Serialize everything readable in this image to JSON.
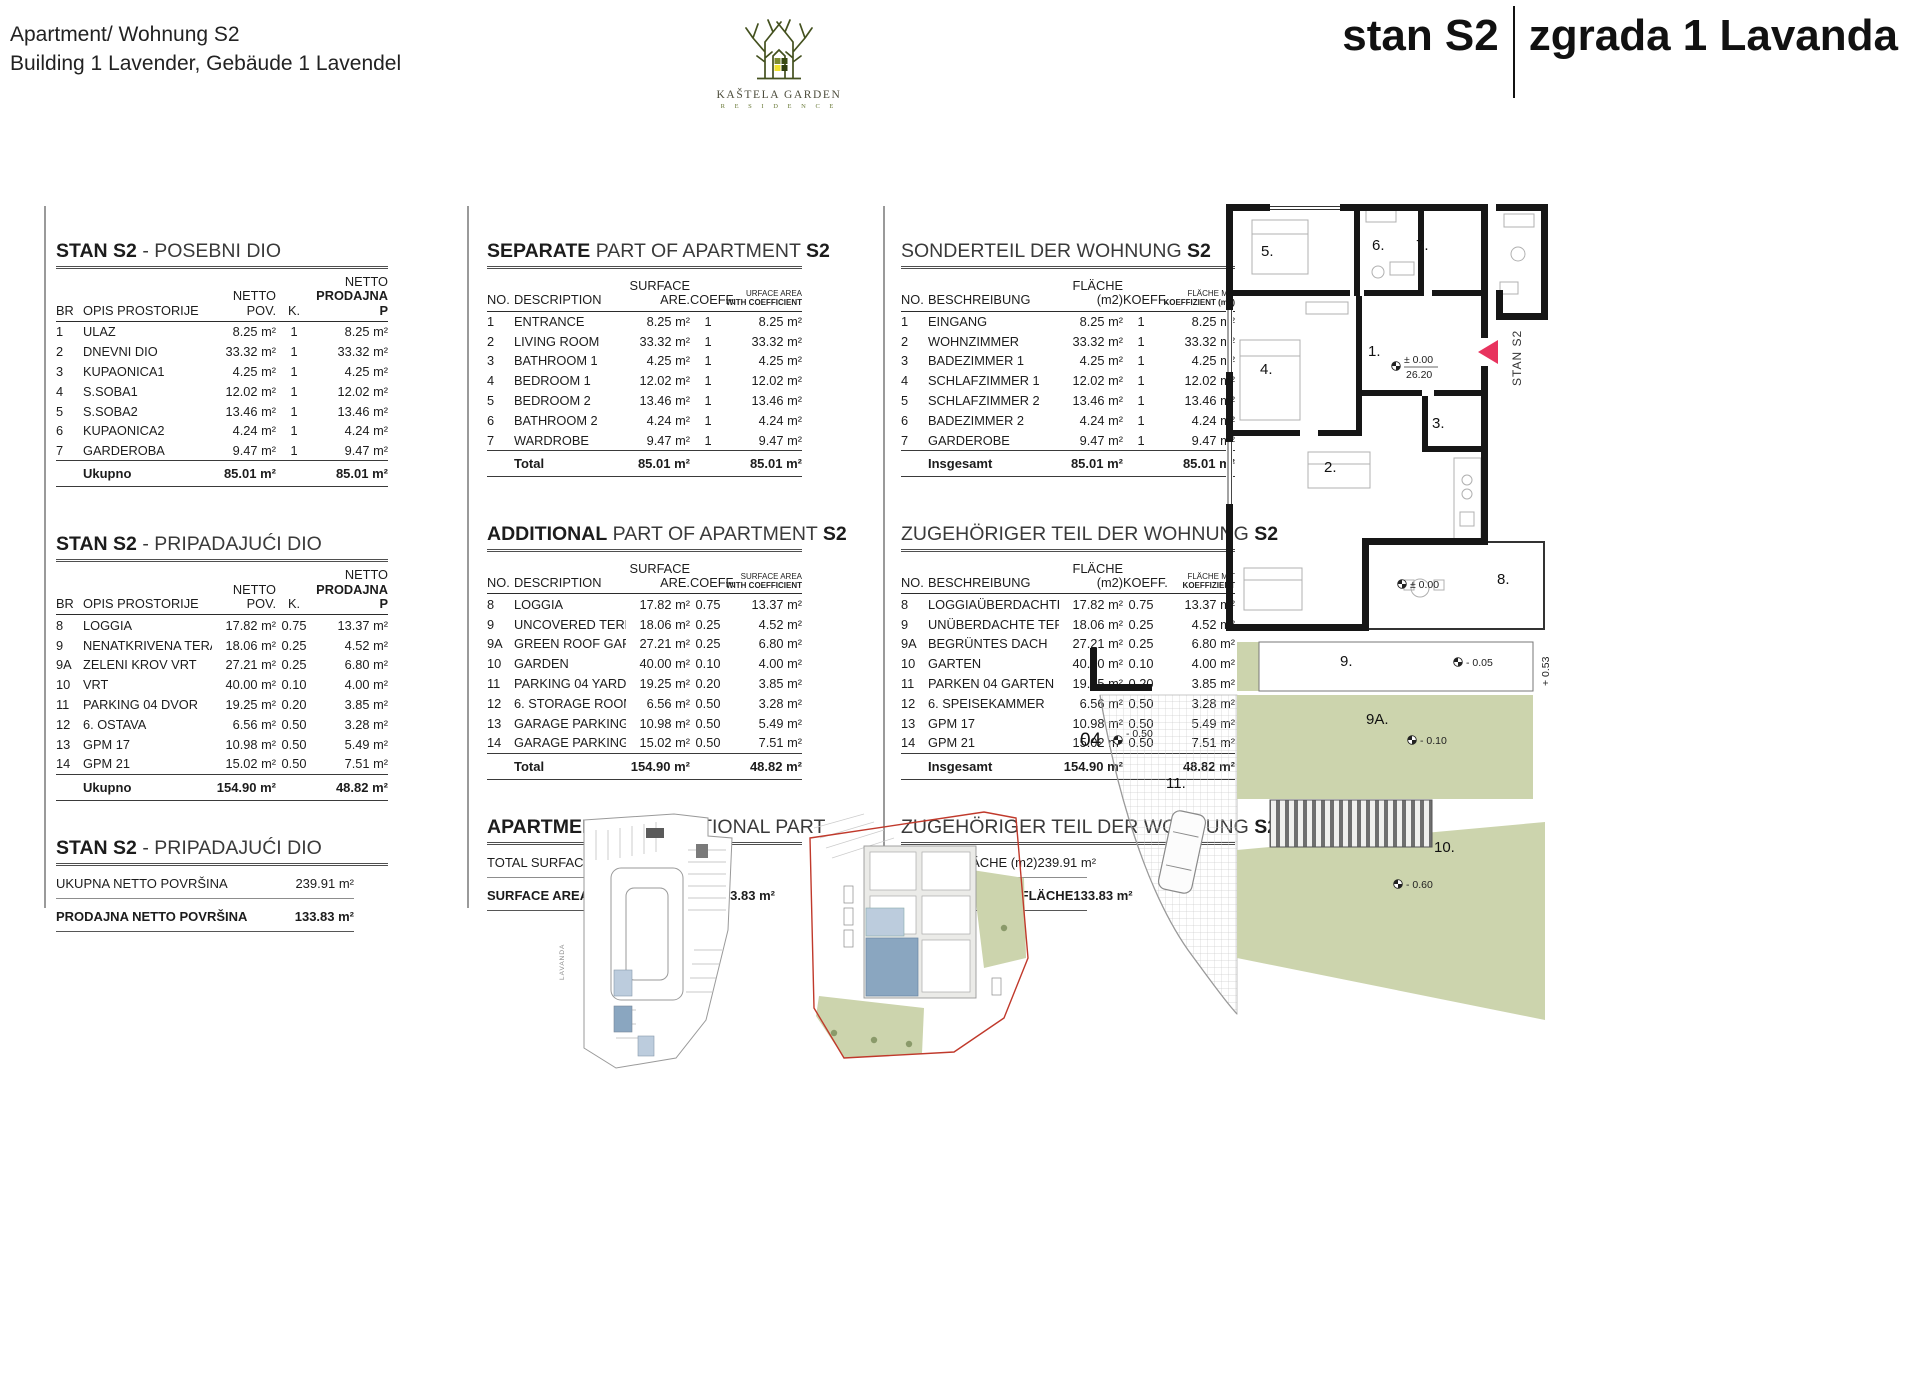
{
  "colors": {
    "green": "#ccd4ad",
    "blue": "#8aa6c0",
    "blue-light": "#bcccdd",
    "red": "#c0392b",
    "flag": "#e8335e",
    "wall": "#161616",
    "furn": "#b0b0b0",
    "logo-green": "#44511f"
  },
  "header": {
    "doc_title_line1": "Apartment/ Wohnung S2",
    "doc_title_line2": "Building 1 Lavender, Gebäude 1 Lavendel",
    "logo_name": "KAŠTELA GARDEN",
    "logo_sub": "R E S I D E N C E",
    "unit_title": "stan S2",
    "building_title": "zgrada 1  Lavanda"
  },
  "t_sep": {
    "rows": [
      {
        "no": "1",
        "hr": "ULAZ",
        "en": "ENTRANCE",
        "de": "EINGANG",
        "area": "8.25 m²",
        "k": "1",
        "net": "8.25 m²"
      },
      {
        "no": "2",
        "hr": "DNEVNI DIO",
        "en": "LIVING ROOM",
        "de": "WOHNZIMMER",
        "area": "33.32 m²",
        "k": "1",
        "net": "33.32 m²"
      },
      {
        "no": "3",
        "hr": "KUPAONICA1",
        "en": "BATHROOM 1",
        "de": "BADEZIMMER 1",
        "area": "4.25 m²",
        "k": "1",
        "net": "4.25 m²"
      },
      {
        "no": "4",
        "hr": "S.SOBA1",
        "en": "BEDROOM 1",
        "de": "SCHLAFZIMMER 1",
        "area": "12.02 m²",
        "k": "1",
        "net": "12.02 m²"
      },
      {
        "no": "5",
        "hr": "S.SOBA2",
        "en": "BEDROOM 2",
        "de": "SCHLAFZIMMER 2",
        "area": "13.46 m²",
        "k": "1",
        "net": "13.46 m²"
      },
      {
        "no": "6",
        "hr": "KUPAONICA2",
        "en": "BATHROOM 2",
        "de": "BADEZIMMER 2",
        "area": "4.24 m²",
        "k": "1",
        "net": "4.24 m²"
      },
      {
        "no": "7",
        "hr": "GARDEROBA",
        "en": "WARDROBE",
        "de": "GARDEROBE",
        "area": "9.47 m²",
        "k": "1",
        "net": "9.47 m²"
      }
    ],
    "tot_area": "85.01 m²",
    "tot_net": "85.01 m²",
    "hr": {
      "p1": "STAN S2",
      "p2": " - POSEBNI DIO",
      "p3": "",
      "no": "BR",
      "desc": "OPIS PROSTORIJE",
      "a1": "NETTO",
      "a2": "POV.",
      "k": "K.",
      "n1": "NETTO",
      "n2": "PRODAJNA P",
      "tot": "Ukupno"
    },
    "en": {
      "p1": "SEPARATE",
      "p2": " PART OF APARTMENT ",
      "p3": "S2",
      "no": "NO.",
      "desc": "DESCRIPTION",
      "a1": "SURFACE",
      "a2": "ARE.",
      "k": "COEFF.",
      "n1": "URFACE AREA",
      "n2": "WITH COEFFICIENT",
      "tot": "Total"
    },
    "de": {
      "p1": "",
      "p2": "SONDERTEIL DER WOHNUNG ",
      "p3": "S2",
      "no": "NO.",
      "desc": "BESCHREIBUNG",
      "a1": "",
      "a2": "FLÄCHE (m2)",
      "k": "KOEFF.",
      "n1": "FLÄCHE MIT",
      "n2": "KOEFFIZIENT (m2)",
      "tot": "Insgesamt"
    }
  },
  "t_add": {
    "rows": [
      {
        "no": "8",
        "hr": "LOGGIA",
        "en": "LOGGIA",
        "de": "LOGGIAÜBERDACHTE",
        "area": "17.82 m²",
        "k": "0.75",
        "net": "13.37 m²"
      },
      {
        "no": "9",
        "hr": "NENATKRIVENA TERASA",
        "en": "UNCOVERED TERRACE",
        "de": "UNÜBERDACHTE TERRASSE",
        "area": "18.06 m²",
        "k": "0.25",
        "net": "4.52 m²"
      },
      {
        "no": "9A",
        "hr": "ZELENI KROV VRT",
        "en": "GREEN ROOF GARDEN",
        "de": "BEGRÜNTES DACH",
        "area": "27.21 m²",
        "k": "0.25",
        "net": "6.80 m²"
      },
      {
        "no": "10",
        "hr": "VRT",
        "en": "GARDEN",
        "de": "GARTEN",
        "area": "40.00 m²",
        "k": "0.10",
        "net": "4.00 m²"
      },
      {
        "no": "11",
        "hr": "PARKING 04 DVOR",
        "en": "PARKING 04 YARD",
        "de": "PARKEN 04 GARTEN",
        "area": "19.25 m²",
        "k": "0.20",
        "net": "3.85 m²"
      },
      {
        "no": "12",
        "hr": "6. OSTAVA",
        "en": "6. STORAGE ROOM",
        "de": "6. SPEISEKAMMER",
        "area": "6.56 m²",
        "k": "0.50",
        "net": "3.28 m²"
      },
      {
        "no": "13",
        "hr": "GPM 17",
        "en": "GARAGE PARKING SPACE 17",
        "de": "GPM 17",
        "area": "10.98 m²",
        "k": "0.50",
        "net": "5.49 m²"
      },
      {
        "no": "14",
        "hr": "GPM 21",
        "en": "GARAGE PARKING SPACE 21",
        "de": "GPM 21",
        "area": "15.02 m²",
        "k": "0.50",
        "net": "7.51 m²"
      }
    ],
    "tot_area": "154.90 m²",
    "tot_net": "48.82 m²",
    "hr": {
      "p1": "STAN S2",
      "p2": " - PRIPADAJUĆI DIO",
      "p3": "",
      "no": "BR",
      "desc": "OPIS PROSTORIJE",
      "a1": "NETTO",
      "a2": "POV.",
      "k": "K.",
      "n1": "NETTO",
      "n2": "PRODAJNA P",
      "tot": "Ukupno"
    },
    "en": {
      "p1": "ADDITIONAL",
      "p2": " PART OF APARTMENT ",
      "p3": "S2",
      "no": "NO.",
      "desc": "DESCRIPTION",
      "a1": "SURFACE",
      "a2": "ARE.",
      "k": "COEFF.",
      "n1": "SURFACE AREA",
      "n2": "WITH COEFFICIENT",
      "tot": "Total"
    },
    "de": {
      "p1": "",
      "p2": "ZUGEHÖRIGER TEIL DER WOHNUNG ",
      "p3": "S2",
      "no": "NO.",
      "desc": "BESCHREIBUNG",
      "a1": "",
      "a2": "FLÄCHE (m2)",
      "k": "KOEFF.",
      "n1": "FLÄCHE MIT",
      "n2": "KOEFFIZIENT",
      "tot": "Insgesamt"
    }
  },
  "t_sum": {
    "hr": {
      "p1": "STAN S2",
      "p2": " - PRIPADAJUĆI DIO",
      "p3": "",
      "r1l": "UKUPNA NETTO POVRŠINA",
      "r1v": "239.91 m²",
      "r2l": "PRODAJNA NETTO POVRŠINA",
      "r2v": "133.83 m²"
    },
    "en": {
      "p1": "APARTMENT S2",
      "p2": " - ADDITIONAL PART",
      "p3": "",
      "r1l": "TOTAL SURFACE AREA",
      "r1v": "239.91 m²",
      "r2l": "SURFACE AREA WITH COEFFICIENT",
      "r2v": "133.83 m²"
    },
    "de": {
      "p1": "",
      "p2": "ZUGEHÖRIGER TEIL DER WOHNUNG ",
      "p3": "S2",
      "r1l": "GESAMTFLÄCHE (m2)",
      "r1v": "239.91 m²",
      "r2l": "NETTO-VERKAUFSFLÄCHE",
      "r2v": "133.83 m²"
    }
  },
  "floorplan": {
    "rooms": [
      "1.",
      "2.",
      "3.",
      "4.",
      "5.",
      "6.",
      "7.",
      "8.",
      "9.",
      "9A.",
      "10.",
      "11."
    ],
    "unit_label": "STAN S2",
    "parking_no": "04",
    "lv_entry": "± 0.00",
    "lv_entry_dim": "26.20",
    "lv_terrace": "± 0.00",
    "lv_strip": "- 0.05",
    "lv_side": "+ 0.53",
    "lv_roof": "- 0.10",
    "lv_drive": "- 0.50",
    "lv_garden": "- 0.60",
    "mini_label": "LAVANDA"
  }
}
